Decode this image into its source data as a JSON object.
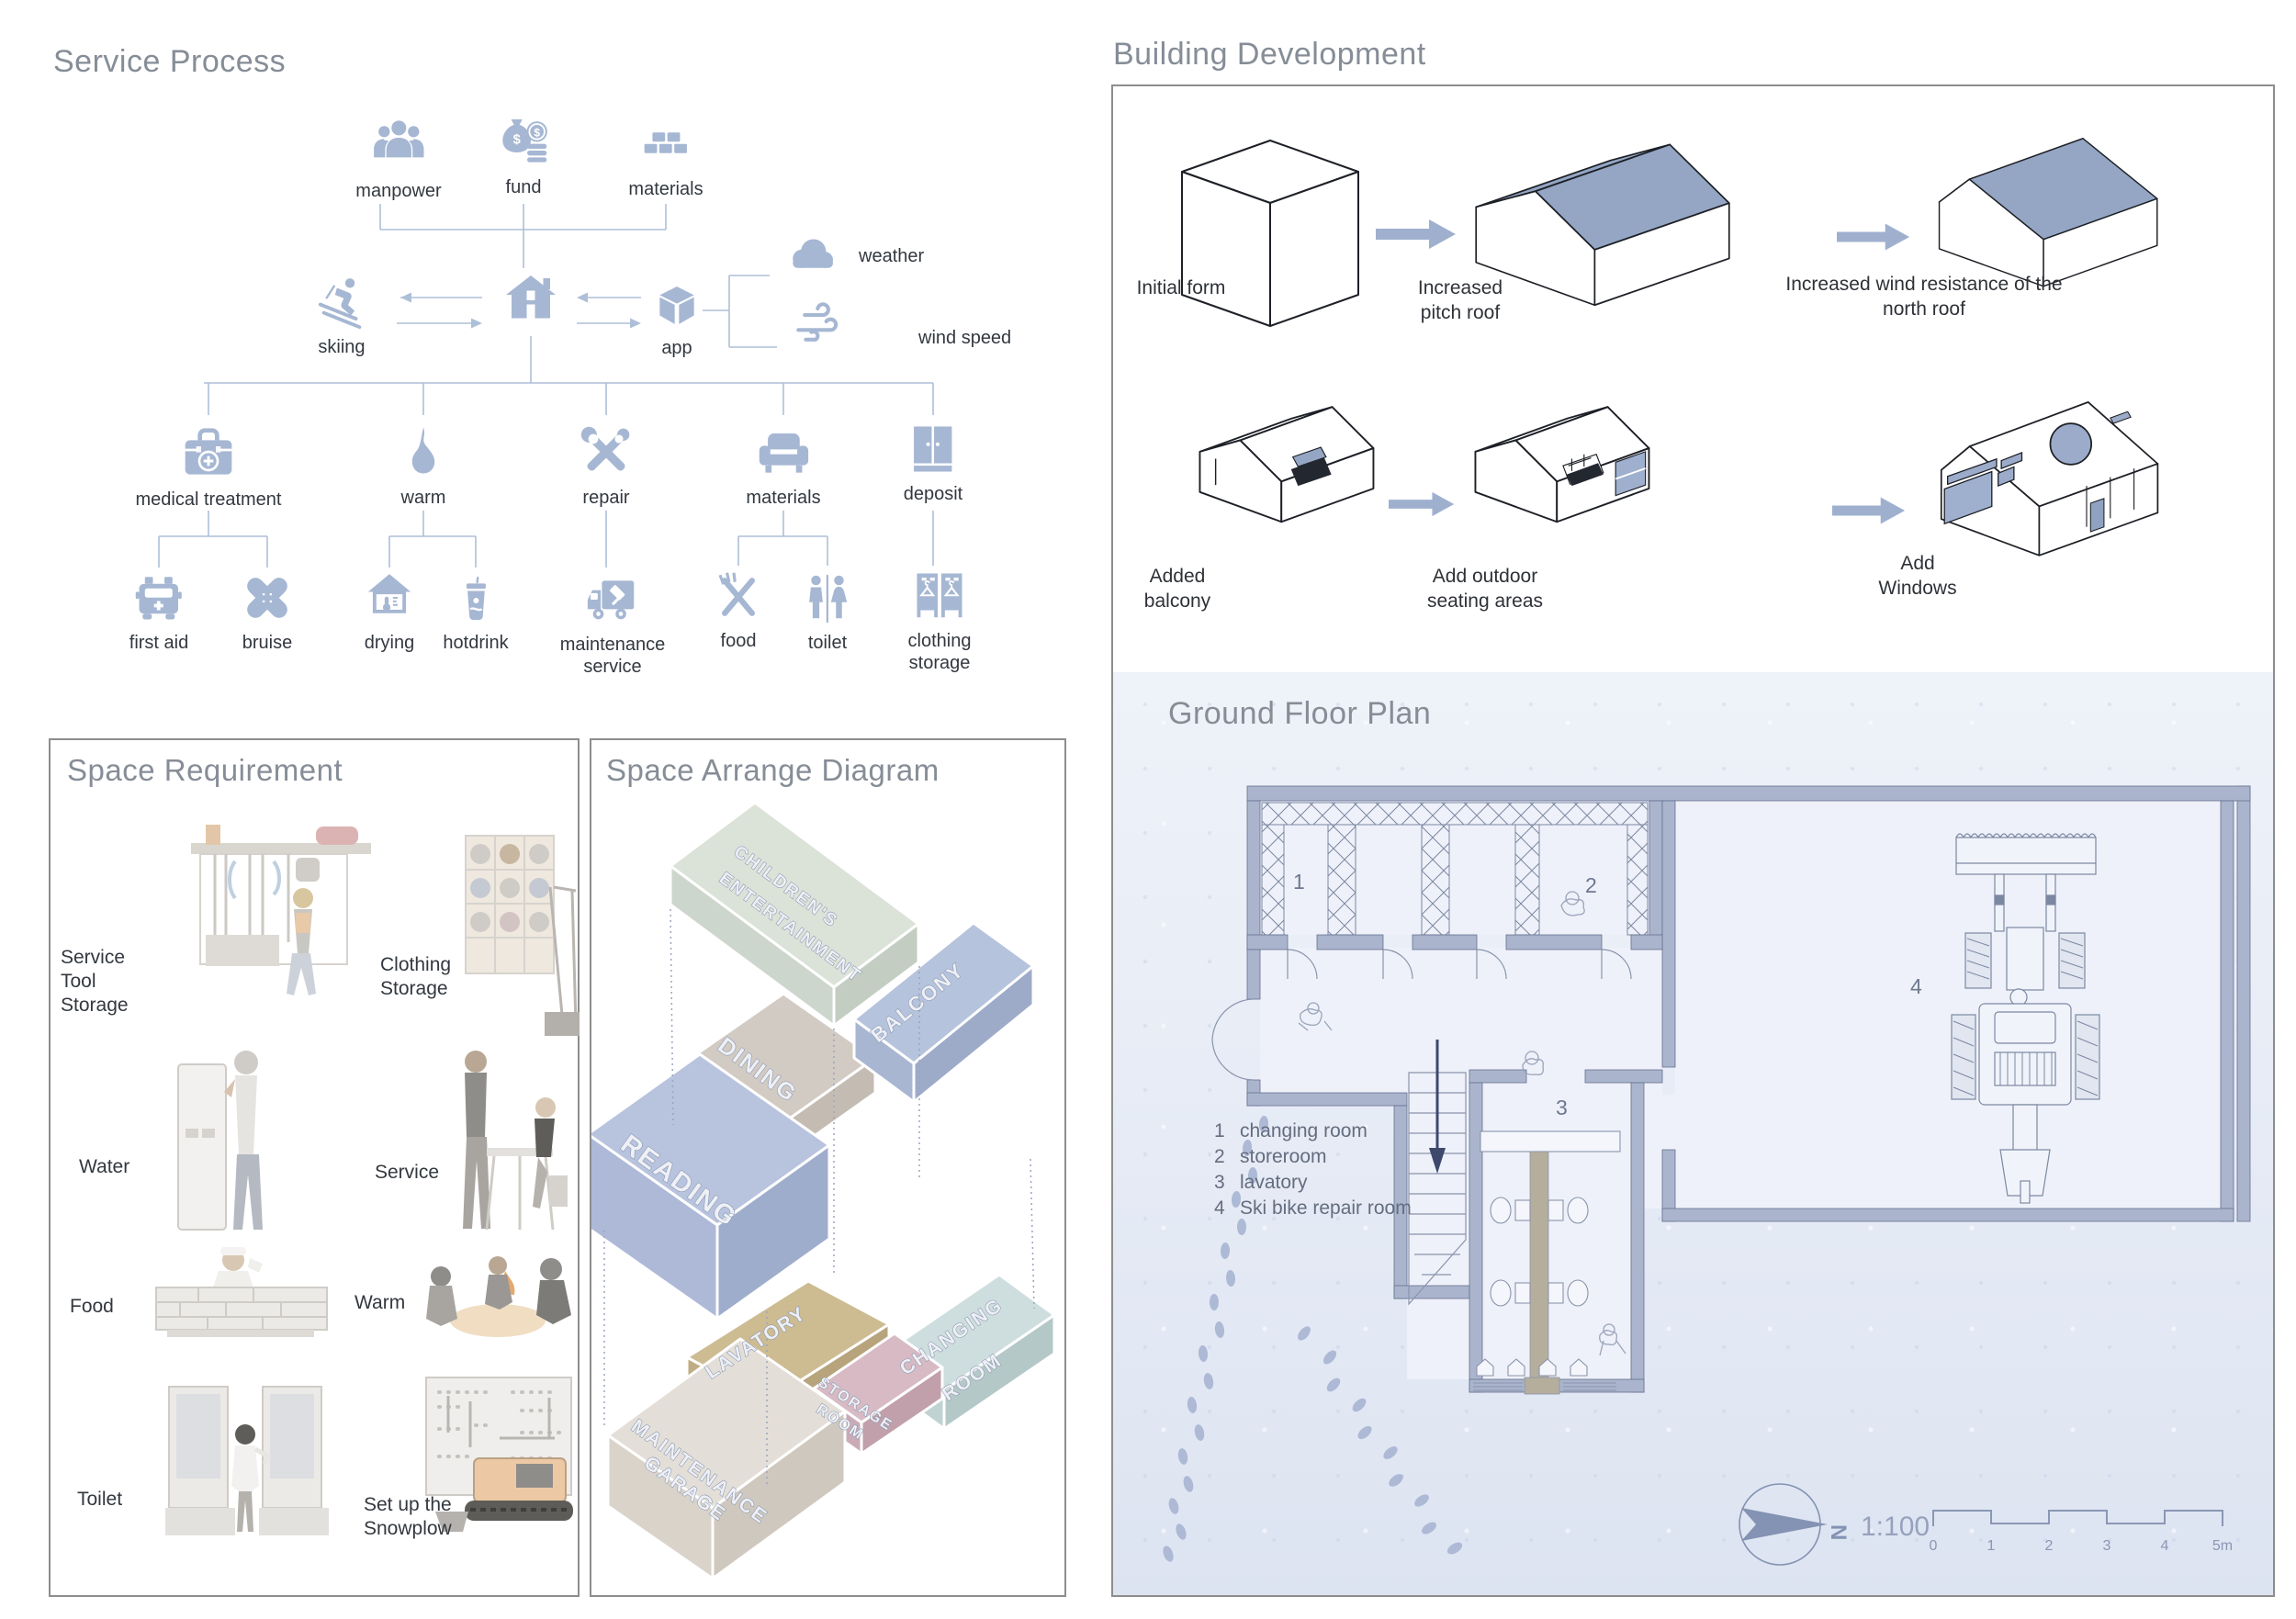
{
  "palette": {
    "icon_blue": "#a6b7d3",
    "line_blue": "#aebfd8",
    "roof_slate": "#94a6c4",
    "wall_blue": "#aab5cd",
    "snow": "#e9edf7",
    "title_gray": "#868d97"
  },
  "service_process": {
    "title": "Service Process",
    "inputs": [
      {
        "label": "manpower",
        "icon": "people-icon"
      },
      {
        "label": "fund",
        "icon": "money-bag-icon"
      },
      {
        "label": "materials",
        "icon": "bricks-icon"
      }
    ],
    "skiing": "skiing",
    "app": "app",
    "weather": "weather",
    "wind_speed": "wind speed",
    "services": [
      "medical treatment",
      "warm",
      "repair",
      "materials",
      "deposit"
    ],
    "sub_services": [
      "first aid",
      "bruise",
      "drying",
      "hotdrink",
      "maintenance service",
      "food",
      "toilet",
      "clothing storage"
    ]
  },
  "space_requirement": {
    "title": "Space Requirement",
    "items": [
      "Service Tool Storage",
      "Clothing Storage",
      "Water",
      "Service",
      "Food",
      "Warm",
      "Toilet",
      "Set up the Snowplow"
    ]
  },
  "space_arrange": {
    "title": "Space Arrange Diagram",
    "rooms": [
      {
        "line1": "CHILDREN'S",
        "line2": "ENTERTAINMENT",
        "color": "#dbe2d8"
      },
      {
        "line1": "DINING",
        "color": "#d2cbc3"
      },
      {
        "line1": "BALCONY",
        "color": "#b6c3dc"
      },
      {
        "line1": "READING",
        "color": "#b8c3de"
      },
      {
        "line1": "LAVATORY",
        "color": "#cdbb92"
      },
      {
        "line1": "CHANGING",
        "line2": "ROOM",
        "color": "#cedddd"
      },
      {
        "line1": "STORAGE",
        "line2": "ROOM",
        "color": "#d7bac3"
      },
      {
        "line1": "MAINTENANCE",
        "line2": "GARAGE",
        "color": "#e3ded7"
      }
    ]
  },
  "building_development": {
    "title": "Building Development",
    "steps": [
      "Initial form",
      "Increased pitch roof",
      "Increased wind resistance of the north roof",
      "Added balcony",
      "Add outdoor seating areas",
      "Add Windows"
    ]
  },
  "ground_floor_plan": {
    "title": "Ground Floor Plan",
    "legend": [
      {
        "num": "1",
        "label": "changing room"
      },
      {
        "num": "2",
        "label": "storeroom"
      },
      {
        "num": "3",
        "label": "lavatory"
      },
      {
        "num": "4",
        "label": "Ski bike repair room"
      }
    ],
    "room_numbers": [
      "1",
      "2",
      "3",
      "4"
    ],
    "compass": "N",
    "scale": "1:100",
    "scale_ticks": [
      "0",
      "1",
      "2",
      "3",
      "4",
      "5m"
    ]
  }
}
